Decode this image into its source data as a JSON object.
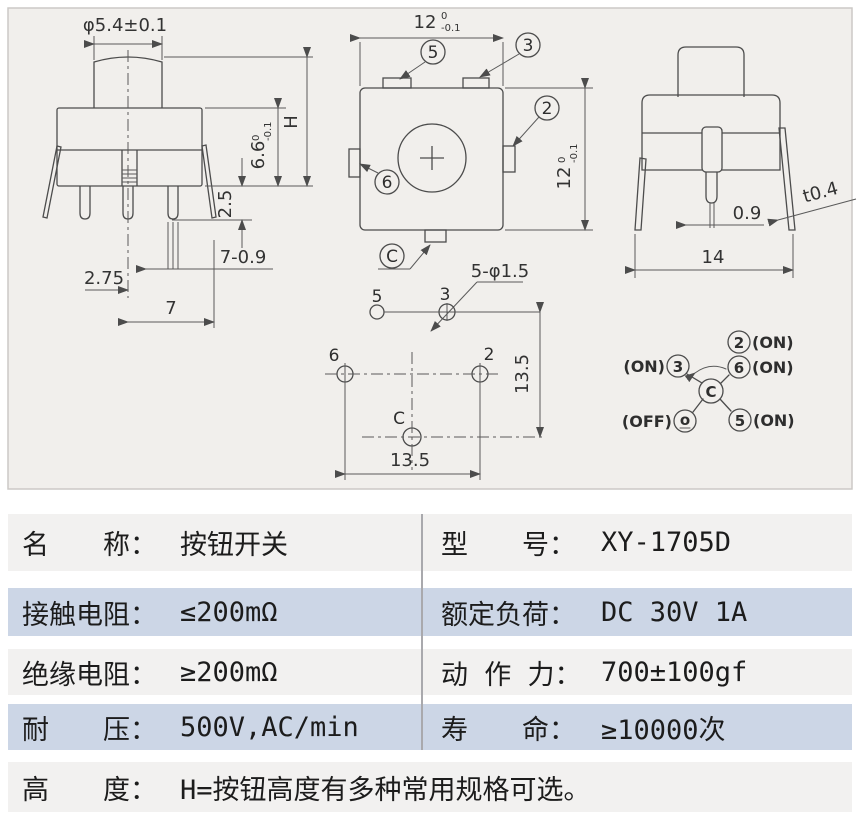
{
  "front_view": {
    "dia": "φ5.4±0.1",
    "height_label": "H",
    "body_h": "6.6",
    "body_h_tol_u": "0",
    "body_h_tol_l": "-0.1",
    "pin_len": "2.5",
    "offset": "2.75",
    "pin_note": "7-0.9",
    "pitch": "7"
  },
  "top_view": {
    "width": "12",
    "width_tol_u": "0",
    "width_tol_l": "-0.1",
    "height": "12",
    "height_tol_u": "0",
    "height_tol_l": "-0.1",
    "pin5": "5",
    "pin3": "3",
    "pin2": "2",
    "pin6": "6",
    "pinC": "C"
  },
  "side_view": {
    "pin_w": "0.9",
    "thickness": "t0.4",
    "width": "14"
  },
  "layout": {
    "hole_note": "5-φ1.5",
    "pin5": "5",
    "pin3": "3",
    "pin6": "6",
    "pin2": "2",
    "pinC": "C",
    "dim_h": "13.5",
    "dim_v": "13.5"
  },
  "circuit": {
    "center": "C",
    "pin3": "3",
    "pin2": "2",
    "pin6": "6",
    "pin5": "5",
    "pin_off": "o",
    "on": "(ON)",
    "off": "(OFF)"
  },
  "table": {
    "rows": [
      {
        "left_label": "名　　称：",
        "left_value": "按钮开关",
        "right_label": "型　　号：",
        "right_value": "XY-1705D"
      },
      {
        "left_label": "接触电阻：",
        "left_value": "≤200mΩ",
        "right_label": "额定负荷：",
        "right_value": "DC 30V 1A"
      },
      {
        "left_label": "绝缘电阻：",
        "left_value": "≥200mΩ",
        "right_label": "动 作 力：",
        "right_value": "700±100gf"
      },
      {
        "left_label": "耐　　压：",
        "left_value": "500V,AC/min",
        "right_label": "寿　　命：",
        "right_value": "≥10000次"
      }
    ],
    "height_row": {
      "label": "高　　度：",
      "value": "H=按钮高度有多种常用规格可选。"
    }
  },
  "colors": {
    "row_blue": "#ccd6e6",
    "row_gray": "#f2f1f0",
    "photo_bg": "#f1efec"
  }
}
